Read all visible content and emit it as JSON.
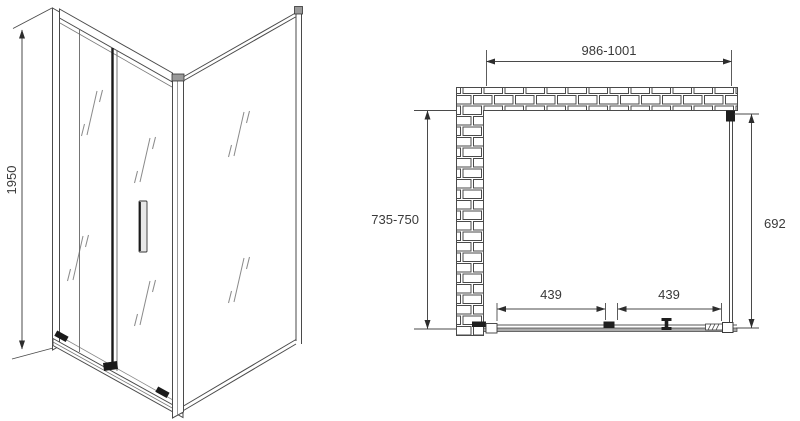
{
  "drawing_type": "shower enclosure technical drawing",
  "views": {
    "isometric": {
      "height_dim": "1950"
    },
    "plan": {
      "width_dim": "986-1001",
      "depth_dim": "735-750",
      "side_glass_dim": "692",
      "door_dims": [
        "439",
        "439"
      ]
    }
  },
  "colors": {
    "line": "#4a4a4a",
    "dark_detail": "#1e1e1e",
    "text": "#3a3a3a",
    "background": "#ffffff"
  }
}
